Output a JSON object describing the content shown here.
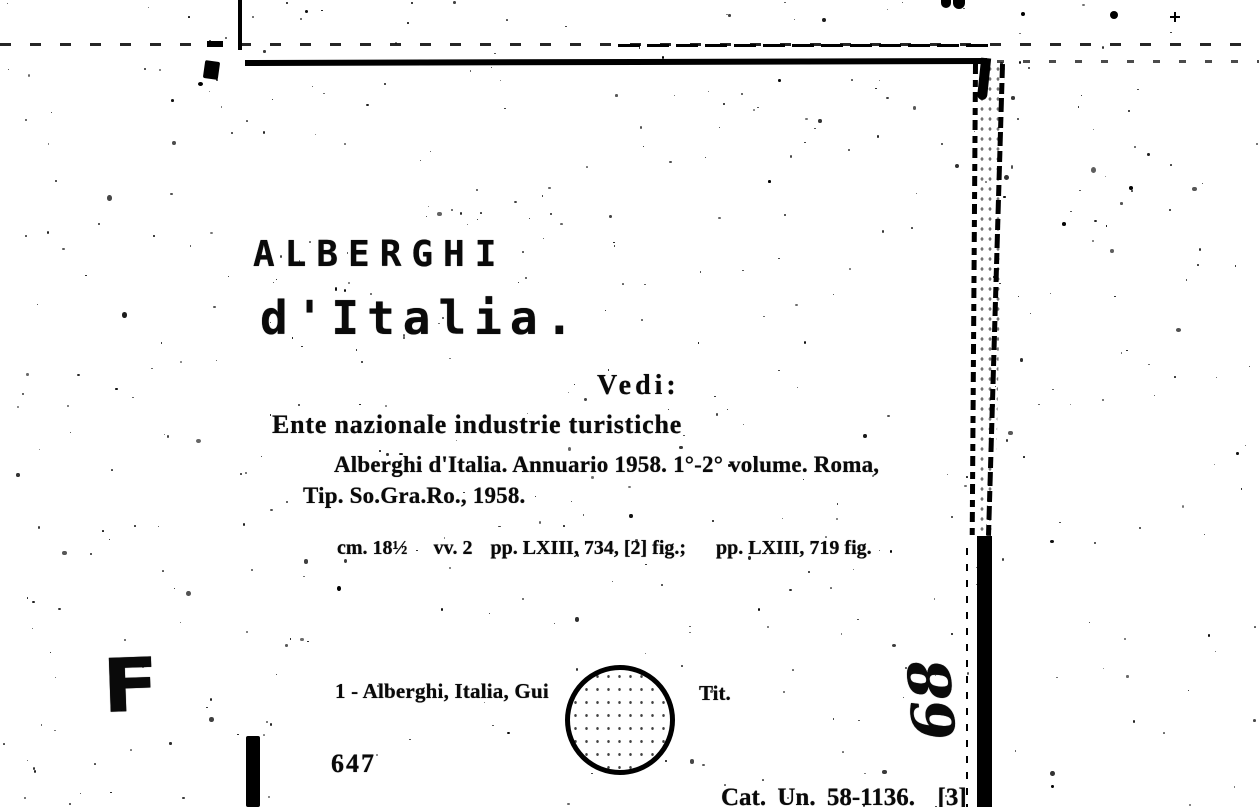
{
  "card": {
    "typed_heading": "ALBERGHI",
    "typed_subheading": "d'Italia.",
    "see_label": "Vedi:",
    "authority": "Ente nazionale industrie turistiche",
    "title_line1": "Alberghi d'Italia. Annuario 1958. 1°-2° volume. Roma,",
    "title_line2": "Tip. So.Gra.Ro., 1958.",
    "collation": {
      "size": "cm. 18½",
      "volumes": "vv. 2",
      "pagination_v1": "pp. LXIII, 734, [2] fig.;",
      "pagination_v2": "pp. LXIII, 719 fig."
    },
    "tracing_prefix": "1 - Alberghi, Italia, Gui",
    "tracing_suffix": "Tit.",
    "card_number": "647",
    "catalog_ref": "Cat. Un. 58-1136.  [3]",
    "stamp_letter": "F",
    "penciled_number": "68"
  },
  "colors": {
    "ink": "#0a0a0a",
    "paper": "#ffffff"
  }
}
